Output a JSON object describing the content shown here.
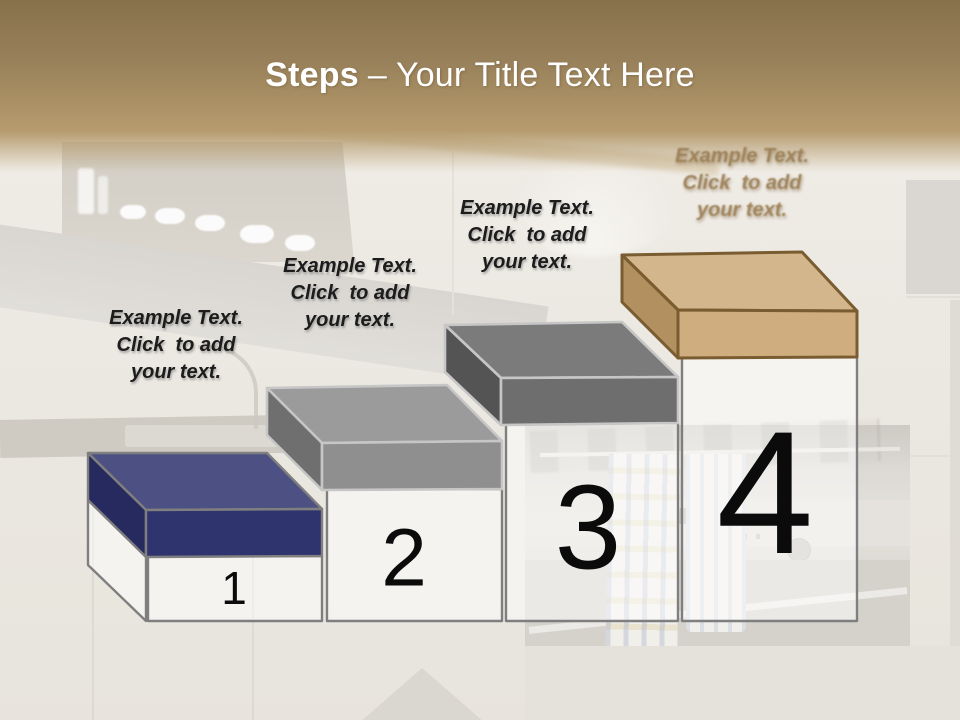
{
  "title": {
    "steps_word": "Steps",
    "separator": "–",
    "rest": "Your Title Text Here",
    "color": "#ffffff"
  },
  "header": {
    "gradient_top": "#87714b",
    "gradient_bottom": "#b59b6e"
  },
  "pedestal": {
    "fill": "rgba(255,255,255,0.5)",
    "outline": "#7f7f7f"
  },
  "number_color": "#0b0b0b",
  "steps": [
    {
      "number": "1",
      "label_lines": [
        "Example Text.",
        "Click  to add",
        "your text."
      ],
      "colors": {
        "top": "#4d5083",
        "left": "#262a5e",
        "front": "#2f336e",
        "outline": "#7f7f7f"
      }
    },
    {
      "number": "2",
      "label_lines": [
        "Example Text.",
        "Click  to add",
        "your text."
      ],
      "colors": {
        "top": "#9b9b9b",
        "left": "#6f6f6f",
        "front": "#8f8f8f",
        "outline": "#c6c6c6"
      }
    },
    {
      "number": "3",
      "label_lines": [
        "Example Text.",
        "Click  to add",
        "your text."
      ],
      "colors": {
        "top": "#7b7b7b",
        "left": "#545454",
        "front": "#6e6e6e",
        "outline": "#c6c6c6"
      }
    },
    {
      "number": "4",
      "label_lines": [
        "Example Text.",
        "Click  to add",
        "your text."
      ],
      "label_color": "#9c7f55",
      "colors": {
        "top": "#d4b68c",
        "left": "#b2905f",
        "front": "#cfad7f",
        "outline": "#7a5c31"
      }
    }
  ]
}
